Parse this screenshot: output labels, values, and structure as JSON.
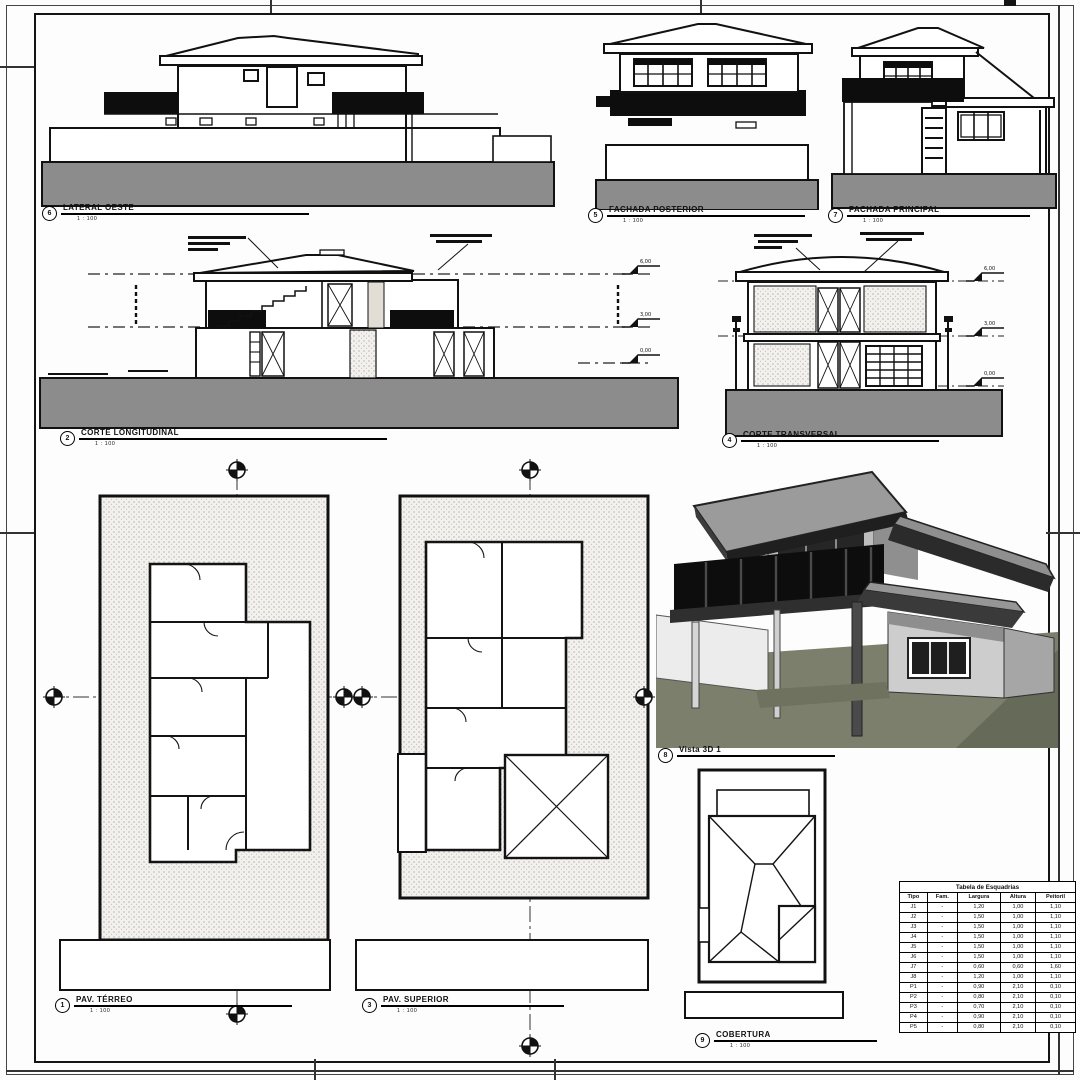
{
  "views": {
    "lateral": {
      "number": "6",
      "title": "LATERAL OESTE",
      "scale": "1 : 100"
    },
    "posterior": {
      "number": "5",
      "title": "FACHADA POSTERIOR",
      "scale": "1 : 100"
    },
    "principal": {
      "number": "7",
      "title": "FACHADA PRINCIPAL",
      "scale": "1 : 100"
    },
    "corte_longitudinal": {
      "number": "2",
      "title": "CORTE LONGITUDINAL",
      "scale": "1 : 100"
    },
    "corte_transversal": {
      "number": "4",
      "title": "CORTE TRANSVERSAL",
      "scale": "1 : 100"
    },
    "vista_3d": {
      "number": "8",
      "title": "Vista 3D 1",
      "scale": ""
    },
    "pav_terreo": {
      "number": "1",
      "title": "PAV. TÉRREO",
      "scale": "1 : 100"
    },
    "pav_superior": {
      "number": "3",
      "title": "PAV. SUPERIOR",
      "scale": "1 : 100"
    },
    "cobertura": {
      "number": "9",
      "title": "COBERTURA",
      "scale": "1 : 100"
    }
  },
  "levels": {
    "roof": "6,00",
    "upper": "3,00",
    "ground": "0,00"
  },
  "schedule": {
    "title": "Tabela de Esquadrias",
    "headers": [
      "Tipo",
      "Fam.",
      "Largura",
      "Altura",
      "Peitoril"
    ],
    "rows": [
      [
        "J1",
        "-",
        "1,20",
        "1,00",
        "1,10"
      ],
      [
        "J2",
        "-",
        "1,50",
        "1,00",
        "1,10"
      ],
      [
        "J3",
        "-",
        "1,50",
        "1,00",
        "1,10"
      ],
      [
        "J4",
        "-",
        "1,50",
        "1,00",
        "1,10"
      ],
      [
        "J5",
        "-",
        "1,50",
        "1,00",
        "1,10"
      ],
      [
        "J6",
        "-",
        "1,50",
        "1,00",
        "1,10"
      ],
      [
        "J7",
        "-",
        "0,60",
        "0,60",
        "1,60"
      ],
      [
        "J8",
        "-",
        "1,20",
        "1,00",
        "1,10"
      ],
      [
        "P1",
        "-",
        "0,90",
        "2,10",
        "0,10"
      ],
      [
        "P2",
        "-",
        "0,80",
        "2,10",
        "0,10"
      ],
      [
        "P3",
        "-",
        "0,70",
        "2,10",
        "0,10"
      ],
      [
        "P4",
        "-",
        "0,90",
        "2,10",
        "0,10"
      ],
      [
        "P5",
        "-",
        "0,80",
        "2,10",
        "0,10"
      ]
    ]
  },
  "colors": {
    "paper": "#ffffff",
    "ink": "#111111",
    "ground_gray": "#8c8c8c",
    "band_black": "#0d0d0d",
    "stipple_bg": "#f3f1ed",
    "render_ground": "#7b7f6c"
  }
}
